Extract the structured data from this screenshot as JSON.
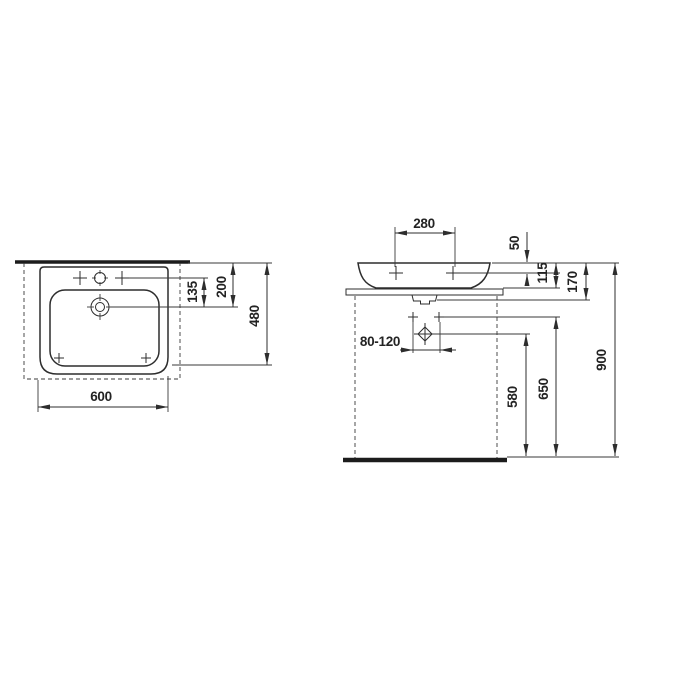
{
  "drawing": {
    "title": "washbasin-dimension-drawing",
    "colors": {
      "line": "#2d2d2d",
      "background": "#ffffff",
      "heavy_line": "#1c1c1c"
    },
    "plan": {
      "dim_tap_to_drain": "135",
      "dim_wall_to_drain": "200",
      "dim_depth": "480",
      "dim_width": "600"
    },
    "elevation": {
      "dim_tap_spacing": "280",
      "dim_rim_to_tap": "50",
      "dim_rim_to_counter": "115",
      "dim_basin_height": "170",
      "dim_drain_range": "80-120",
      "dim_floor_to_drain": "580",
      "dim_floor_to_fixing": "650",
      "dim_floor_to_rim": "900"
    }
  }
}
